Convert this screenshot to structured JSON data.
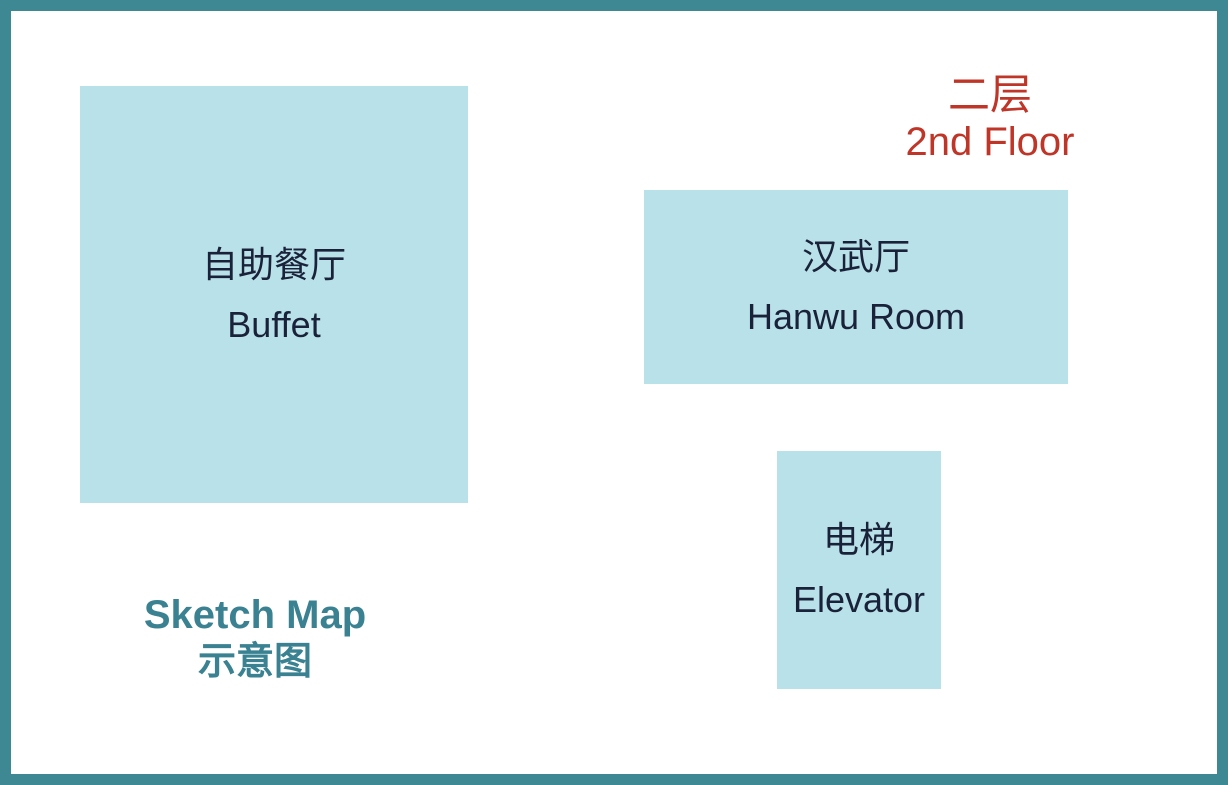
{
  "floor_title": {
    "zh": "二层",
    "en": "2nd Floor"
  },
  "rooms": [
    {
      "name": "buffet",
      "zh": "自助餐厅",
      "en": "Buffet"
    },
    {
      "name": "hanwu-room",
      "zh": "汉武厅",
      "en": "Hanwu Room"
    },
    {
      "name": "elevator",
      "zh": "电梯",
      "en": "Elevator"
    }
  ],
  "legend": {
    "en": "Sketch Map",
    "zh": "示意图"
  },
  "colors": {
    "background": "#ffffff",
    "frame_border": "#3e8893",
    "room_fill": "#b9e1e9",
    "room_text": "#1a2239",
    "floor_title_text": "#bf3527",
    "legend_text": "#3a8291"
  }
}
